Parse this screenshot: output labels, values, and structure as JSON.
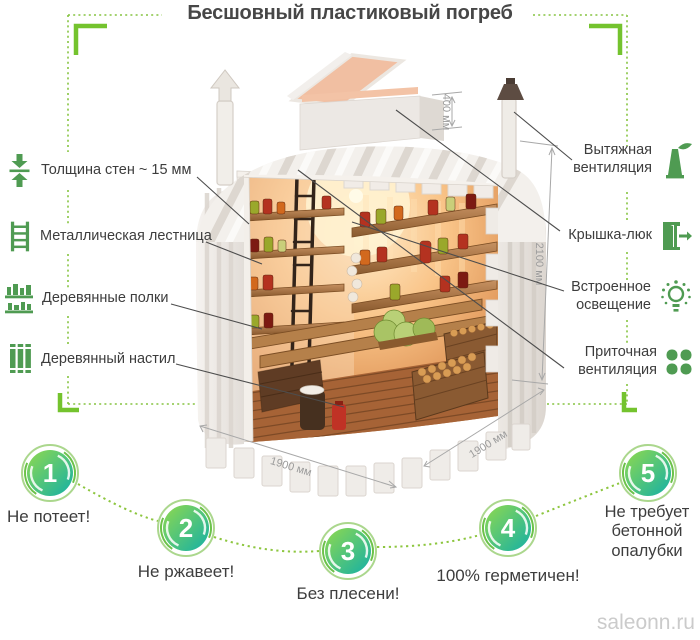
{
  "title": "Бесшовный пластиковый погреб",
  "left_features": [
    {
      "icon": "wall-thickness-icon",
      "label": "Толщина стен ~ 15 мм"
    },
    {
      "icon": "ladder-icon",
      "label": "Металлическая лестница"
    },
    {
      "icon": "shelves-icon",
      "label": "Деревянные полки"
    },
    {
      "icon": "planks-icon",
      "label": "Деревянный настил"
    }
  ],
  "right_features": [
    {
      "icon": "exhaust-vent-icon",
      "label": "Вытяжная вентиляция"
    },
    {
      "icon": "hatch-door-icon",
      "label": "Крышка-люк"
    },
    {
      "icon": "light-bulb-icon",
      "label": "Встроенное освещение"
    },
    {
      "icon": "supply-fan-icon",
      "label": "Приточная вентиляция"
    }
  ],
  "dimensions": {
    "hatch": "400 мм",
    "height": "2100 мм",
    "width": "1900 мм",
    "depth": "1900 мм"
  },
  "benefits": [
    {
      "number": "1",
      "label": "Не потеет!"
    },
    {
      "number": "2",
      "label": "Не ржавеет!"
    },
    {
      "number": "3",
      "label": "Без плесени!"
    },
    {
      "number": "4",
      "label": "100% герметичен!"
    },
    {
      "number": "5",
      "label": "Не требует бетонной опалубки"
    }
  ],
  "watermark": "saleonn.ru",
  "colors": {
    "accent_green": "#4f9b52",
    "lime_green": "#79c33a",
    "circle_gradient_start": "#90d94e",
    "circle_gradient_end": "#14b0a6",
    "wood": "#a97342",
    "interior_glow": "#ffeac2"
  }
}
